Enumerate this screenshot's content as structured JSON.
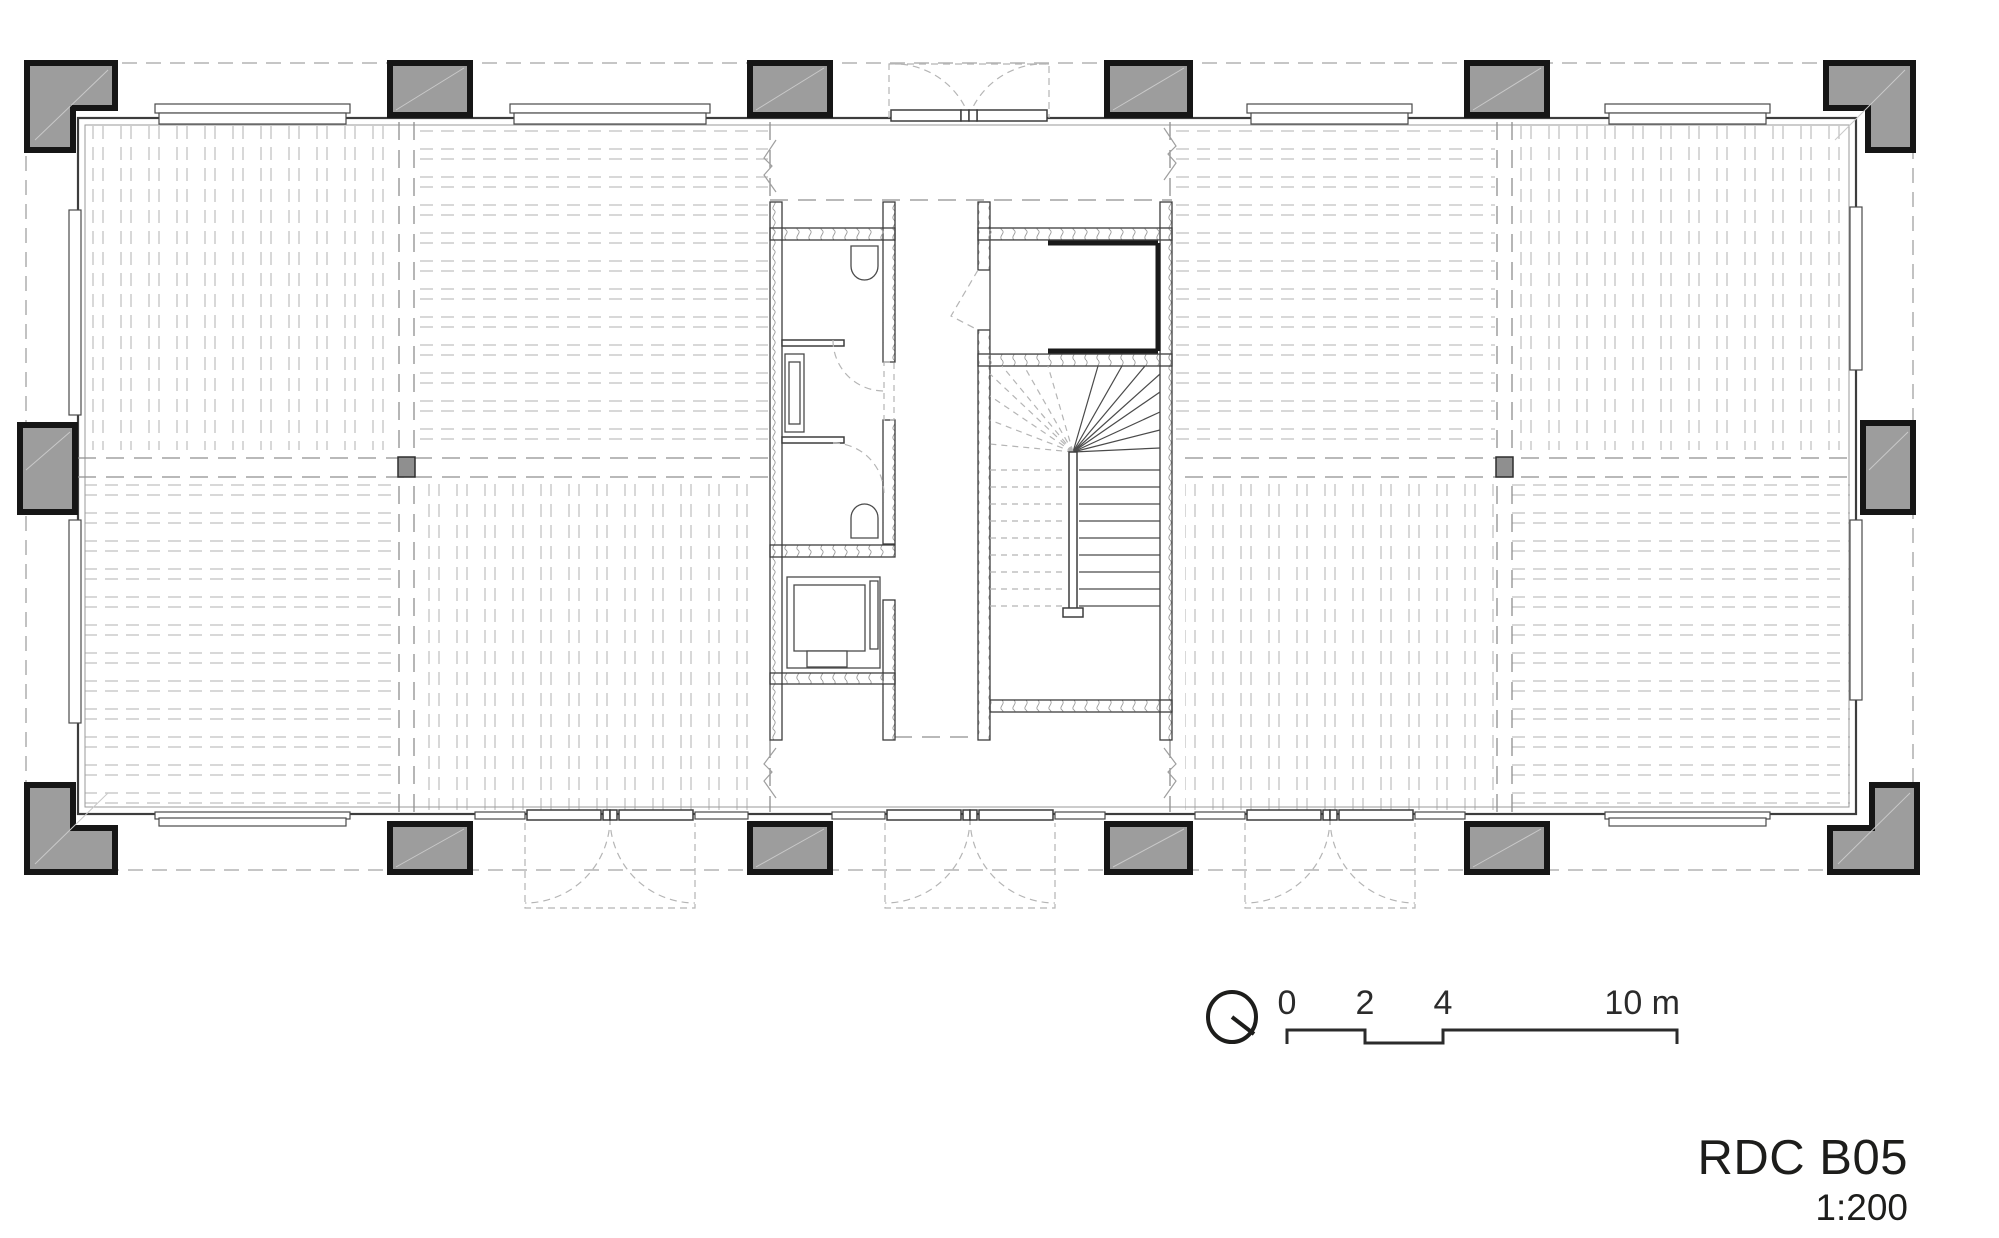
{
  "sheet": {
    "title": "RDC B05",
    "scale_ratio": "1:200",
    "drawing_type": "floor-plan"
  },
  "scale_bar": {
    "labels": [
      "0",
      "2",
      "4",
      "10 m"
    ],
    "unit": "m"
  },
  "north_indicator": {
    "icon": "circle-bearing-icon"
  },
  "colors": {
    "column_fill": "#9d9d9d",
    "wall_line": "#3d3d3d",
    "grid_dash": "#8f8f8f",
    "hatch_line": "#c3c3c3",
    "ink": "#1d1d1b"
  }
}
